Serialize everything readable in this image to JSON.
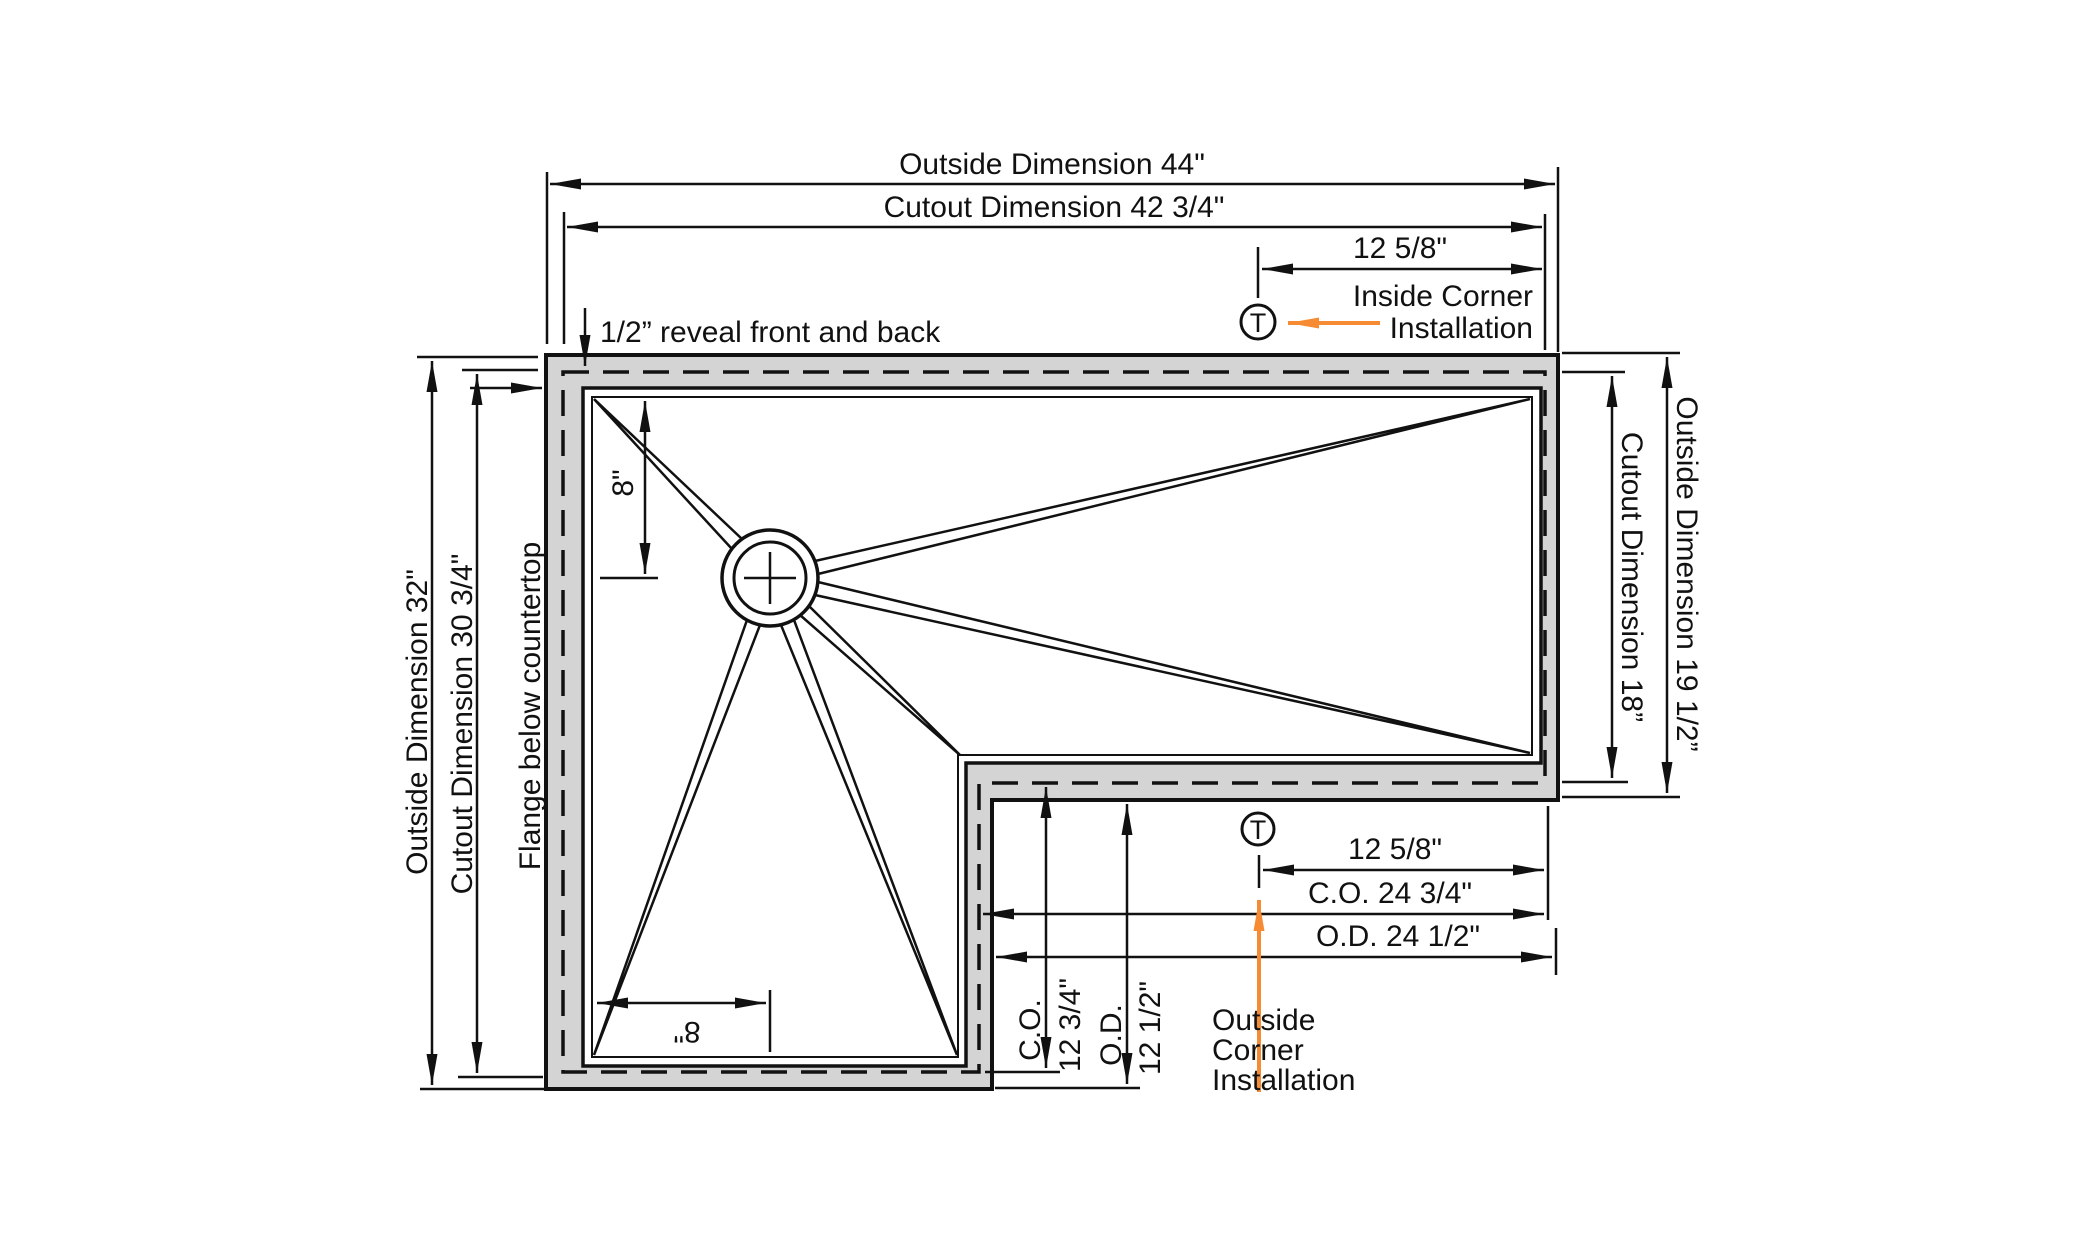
{
  "figure": {
    "type": "corner-sink-installation-dimension-diagram",
    "colors": {
      "accent": "#F68B33",
      "flange_fill": "#D4D4D4",
      "line": "#111111"
    },
    "top": {
      "outside_dimension": "Outside Dimension 44\"",
      "cutout_dimension": "Cutout Dimension 42 3/4\"",
      "corner_offset": "12 5/8\"",
      "inside_corner_line1": "Inside Corner",
      "inside_corner_line2": "Installation",
      "reveal_note": "1/2” reveal front and back",
      "t_marker": "T"
    },
    "left": {
      "outside_dimension": "Outside Dimension 32\"",
      "cutout_dimension": "Cutout Dimension 30 3/4\"",
      "flange_note": "Flange below countertop"
    },
    "right": {
      "cutout_dimension": "Cutout Dimension 18”",
      "outside_dimension": "Outside Dimension 19 1/2”"
    },
    "bowl": {
      "drain_offset_from_back": "8\"",
      "drain_offset_from_left": "8\""
    },
    "bottom": {
      "corner_offset": "12 5/8\"",
      "cutout_dimension": "C.O. 24 3/4\"",
      "outside_dimension": "O.D. 24 1/2\"",
      "vertical_cutout_label": "C.O.",
      "vertical_cutout_value": "12 3/4\"",
      "vertical_outside_label": "O.D.",
      "vertical_outside_value": "12 1/2\"",
      "outside_corner_line1": "Outside",
      "outside_corner_line2": "Corner",
      "outside_corner_line3": "Installation",
      "t_marker": "T"
    }
  }
}
